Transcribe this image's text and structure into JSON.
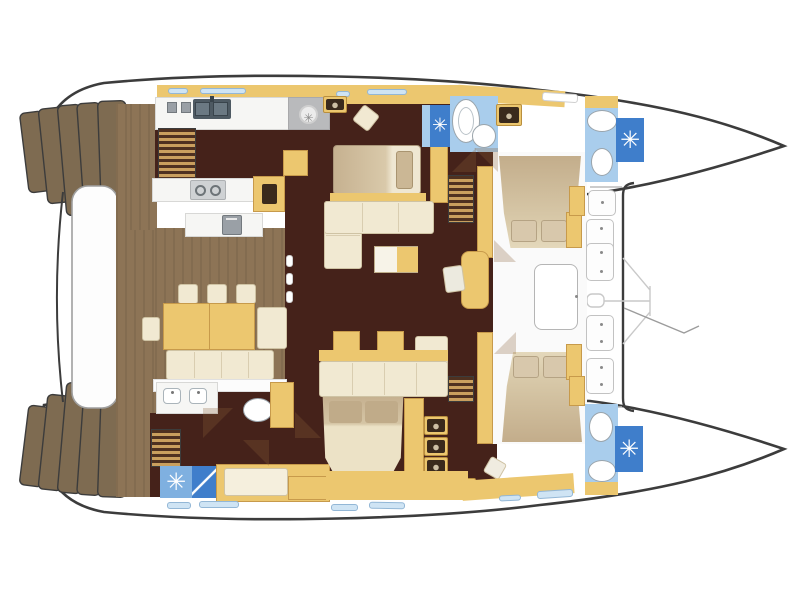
{
  "title": "Catamaran yacht interior layout — top-view floor plan, bows to the right",
  "boat": {
    "type": "catamaran",
    "view": "top-down floor plan",
    "bow_direction": "right",
    "hulls": 2
  },
  "palette": {
    "outline": "#3c3c3c",
    "hull_white": "#ffffff",
    "teak": "#8d7456",
    "step_brown": "#7e6b51",
    "chocolate": "#45221a",
    "gold": "#ecc76f",
    "gold_edge": "#c79a4b",
    "gold_light": "#f3dc9e",
    "cream": "#f1e9d2",
    "cream_edge": "#cfc3a4",
    "bed_tan": "#c8b292",
    "counter": "#f6f6f4",
    "counter_edge": "#d8d8d6",
    "bath_blue": "#a9cdec",
    "shower_blue": "#3f7ecb",
    "shower_light": "#7fb0e0",
    "appliance_gray": "#9aa0a6",
    "stove_gray": "#b9babc",
    "window_blue": "#cfe4f4",
    "window_edge": "#93b7d6",
    "platform_edge": "#a0a0a0"
  },
  "glyphs": {
    "shower_drain": "✳",
    "fan": "✳"
  },
  "legend": {
    "areas": [
      "transom-steps-port",
      "transom-steps-starboard",
      "aft-platform",
      "aft-deck-cockpit",
      "cockpit-dining",
      "galley",
      "salon",
      "aft-cabin",
      "master-cabin",
      "master-bathroom",
      "forward-lounge-cabin",
      "guest-bathroom-aft",
      "guest-bathroom-forward",
      "port-forward-bathroom",
      "foredeck",
      "trampoline",
      "anchor-gear"
    ],
    "counts": {
      "shower_stalls": 4,
      "toilets": 4,
      "deck_hatches": 4,
      "transom_step_flights": 2,
      "dining_chairs": 4,
      "facing_lounge_beds": 2
    }
  }
}
